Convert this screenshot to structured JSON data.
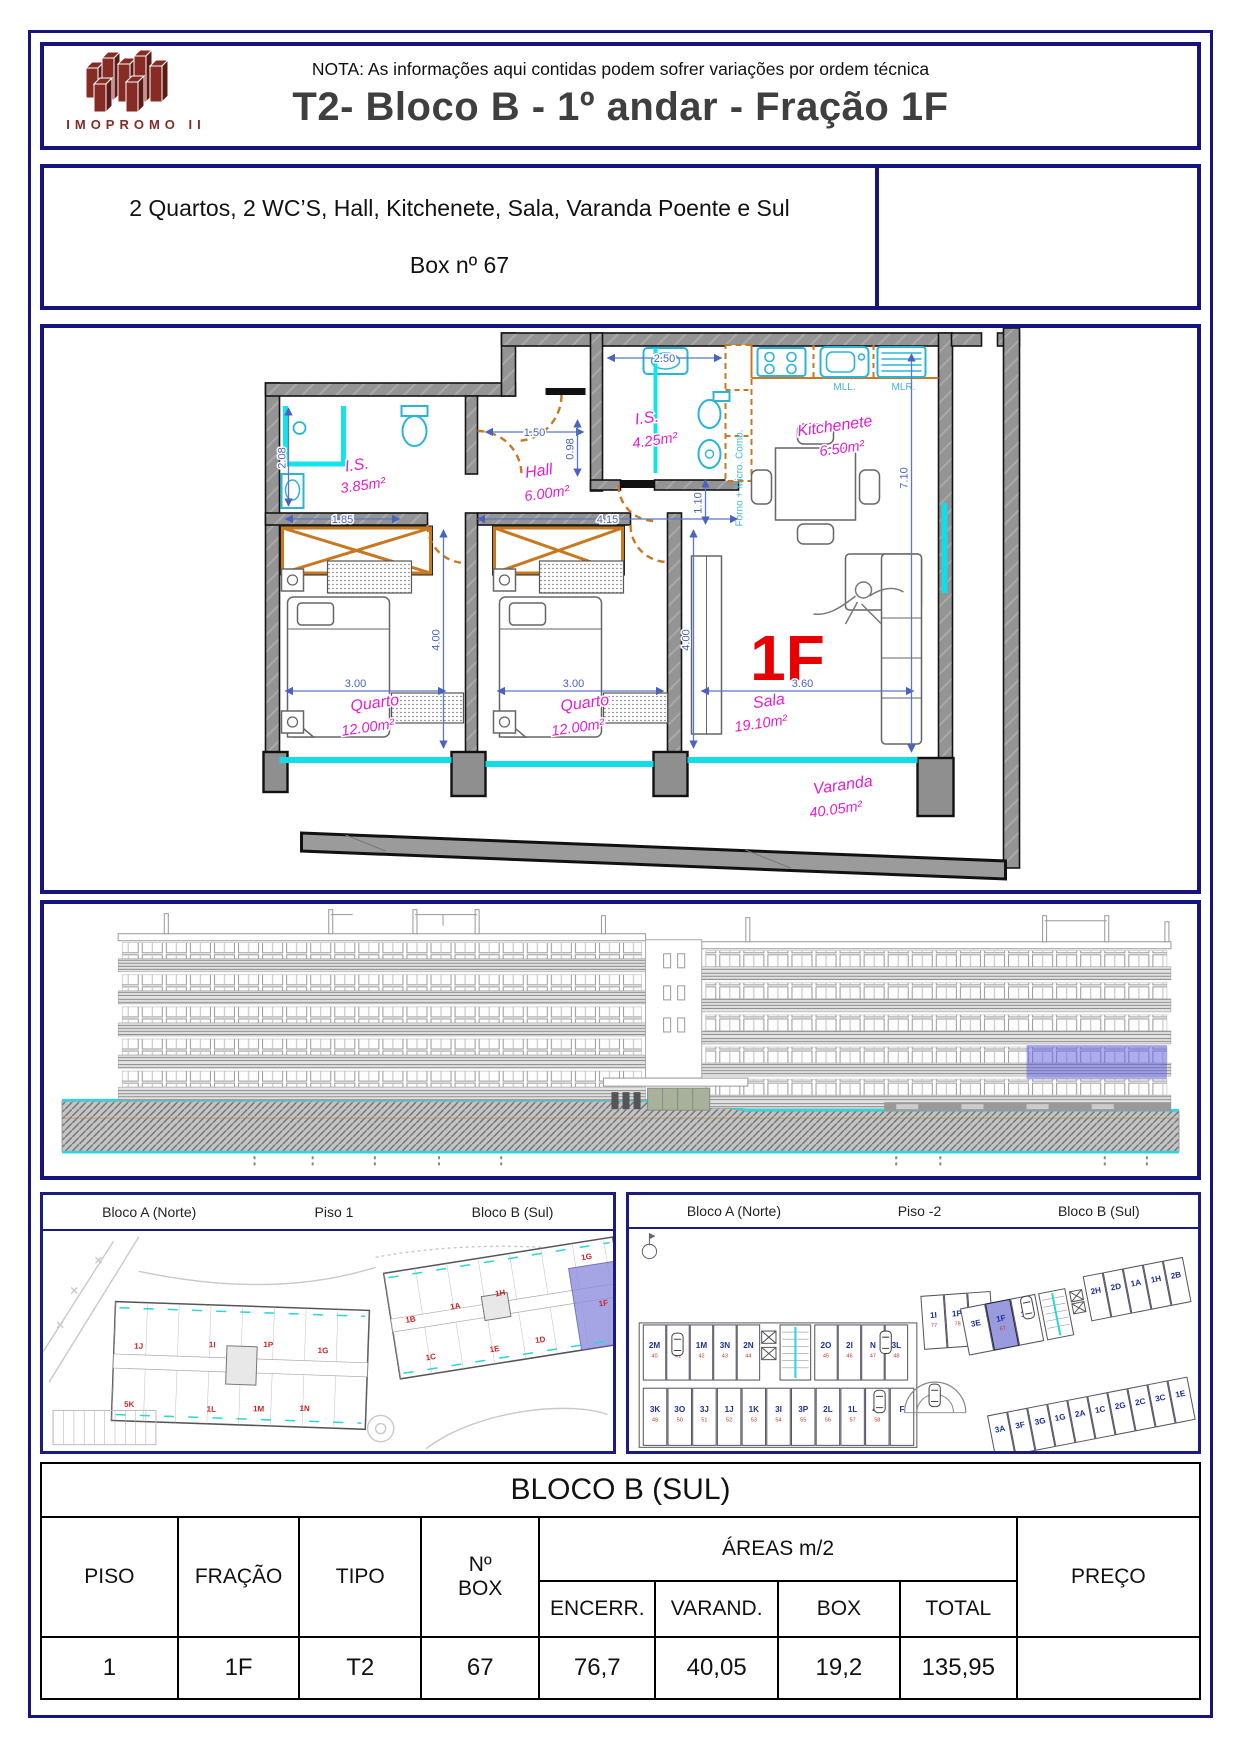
{
  "header": {
    "note": "NOTA: As informações aqui contidas podem sofrer variações por ordem técnica",
    "title": "T2- Bloco B - 1º andar - Fração 1F",
    "logo_text": "IMOPROMO II"
  },
  "description": {
    "line1": "2 Quartos, 2 WC’S, Hall, Kitchenete, Sala, Varanda Poente e Sul",
    "line2": "Box nº 67"
  },
  "floor_plan": {
    "unit_label": "1F",
    "rooms": [
      {
        "name": "I.S.",
        "area": "3.85m²"
      },
      {
        "name": "Hall",
        "area": "6.00m²"
      },
      {
        "name": "I.S.",
        "area": "4.25m²"
      },
      {
        "name": "Kitchenete",
        "area": "6.50m²"
      },
      {
        "name": "Quarto",
        "area": "12.00m²"
      },
      {
        "name": "Quarto",
        "area": "12.00m²"
      },
      {
        "name": "Sala",
        "area": "19.10m²"
      },
      {
        "name": "Varanda",
        "area": "40.05m²"
      }
    ],
    "dims": {
      "is2_w": "2.50",
      "hall_w": "1.50",
      "hall_h": "0.98",
      "is1_h": "2.08",
      "is1_w": "1.85",
      "corridor_w": "4.15",
      "passage_h": "1.10",
      "quarto1_h": "4.00",
      "quarto2_h": "4.00",
      "quarto1_w": "3.00",
      "quarto2_w": "3.00",
      "sala_w": "3.60",
      "side_h": "7.10"
    },
    "annotations": {
      "sink": "MLL.",
      "washer": "MLR.",
      "oven": "Forno + Micro. Comb."
    }
  },
  "panels": {
    "piso1": {
      "left": "Bloco A (Norte)",
      "center": "Piso 1",
      "right": "Bloco B (Sul)",
      "blocoA_units": [
        "1J",
        "1I",
        "1P",
        "1G",
        "5K",
        "1L",
        "1M",
        "1N"
      ],
      "blocoB_units": [
        "1B",
        "1A",
        "1H",
        "1G",
        "1C",
        "1E",
        "1D",
        "1F"
      ]
    },
    "piso2": {
      "left": "Bloco A (Norte)",
      "center": "Piso -2",
      "right": "Bloco B (Sul)",
      "rows": {
        "top_left": [
          {
            "label": "2M",
            "num": "40"
          },
          {
            "label": "1O",
            "num": "41"
          },
          {
            "label": "1M",
            "num": "42"
          },
          {
            "label": "3N",
            "num": "43"
          },
          {
            "label": "2N",
            "num": "44"
          }
        ],
        "top_mid": [
          {
            "label": "2O",
            "num": "45"
          },
          {
            "label": "2I",
            "num": "46"
          },
          {
            "label": "N",
            "num": "47"
          },
          {
            "label": "3L",
            "num": "48"
          }
        ],
        "trio": [
          {
            "label": "1I",
            "num": "77"
          },
          {
            "label": "1P",
            "num": "78"
          },
          {
            "label": "4D",
            "num": "79"
          }
        ],
        "b_top": [
          {
            "label": "3E"
          },
          {
            "label": "1F",
            "num": "67",
            "hl": true
          },
          {
            "label": "1D"
          }
        ],
        "b_diag": [
          {
            "label": "2H"
          },
          {
            "label": "2D"
          },
          {
            "label": "1A"
          },
          {
            "label": "1H"
          },
          {
            "label": "2B"
          }
        ],
        "b_right": [
          {
            "label": "3A"
          },
          {
            "label": "3F"
          },
          {
            "label": "3G"
          },
          {
            "label": "1G"
          },
          {
            "label": "2A"
          },
          {
            "label": "1C"
          },
          {
            "label": "2G"
          },
          {
            "label": "2C"
          },
          {
            "label": "3C"
          },
          {
            "label": "1E"
          }
        ],
        "bottom": [
          {
            "label": "3K",
            "num": "49"
          },
          {
            "label": "3O",
            "num": "50"
          },
          {
            "label": "3J",
            "num": "51"
          },
          {
            "label": "1J",
            "num": "52"
          },
          {
            "label": "1K",
            "num": "53"
          },
          {
            "label": "3I",
            "num": "54"
          },
          {
            "label": "3P",
            "num": "55"
          },
          {
            "label": "2L",
            "num": "56"
          },
          {
            "label": "1L",
            "num": "57"
          },
          {
            "label": "4E",
            "num": "58"
          },
          {
            "label": "F"
          }
        ]
      }
    }
  },
  "table": {
    "title": "BLOCO B (SUL)",
    "headers": {
      "piso": "PISO",
      "fracao": "FRAÇÃO",
      "tipo": "TIPO",
      "box1": "Nº",
      "box2": "BOX",
      "areas": "ÁREAS m/2",
      "encerr": "ENCERR.",
      "varand": "VARAND.",
      "box": "BOX",
      "total": "TOTAL",
      "preco": "PREÇO"
    },
    "row": {
      "piso": "1",
      "fracao": "1F",
      "tipo": "T2",
      "box": "67",
      "encerr": "76,7",
      "varand": "40,05",
      "box_area": "19,2",
      "total": "135,95",
      "preco": ""
    }
  },
  "colors": {
    "frame": "#15157d",
    "highlight": "#8f8fe0",
    "accent_red": "#e80000",
    "magenta": "#e11ed1",
    "cyan": "#12dce6",
    "orange": "#c87820",
    "logo": "#872b25"
  }
}
